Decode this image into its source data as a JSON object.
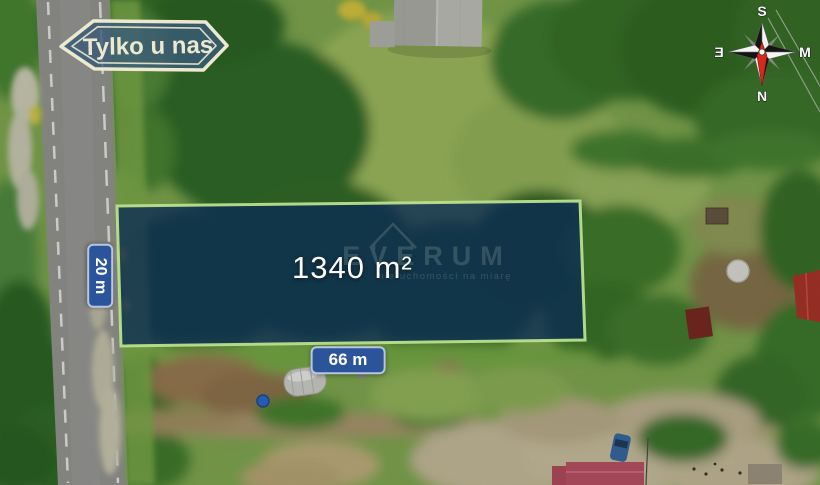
{
  "listing_badge": {
    "label": "Tylko u nas"
  },
  "plot": {
    "area_label": "1340 m²",
    "frontage_label": "66 m",
    "depth_label": "20 m",
    "outline_color": "#b9e08d",
    "fill_color": "#0a2a55"
  },
  "watermark": {
    "brand": "EVERUM",
    "tagline": "nieruchomości na miarę"
  },
  "compass": {
    "top_label": "S",
    "right_label": "M",
    "bottom_label": "N",
    "left_label": "Ǝ",
    "needle_color": "#d42a1e"
  },
  "colors": {
    "dim_label_background": "#2b549b",
    "dim_label_border": "#dfe7f5",
    "badge_fill": "#3b5a78",
    "badge_outline": "#ece9d0",
    "road_asphalt": "#9c9c98",
    "road_marking": "#f2f2ee"
  }
}
